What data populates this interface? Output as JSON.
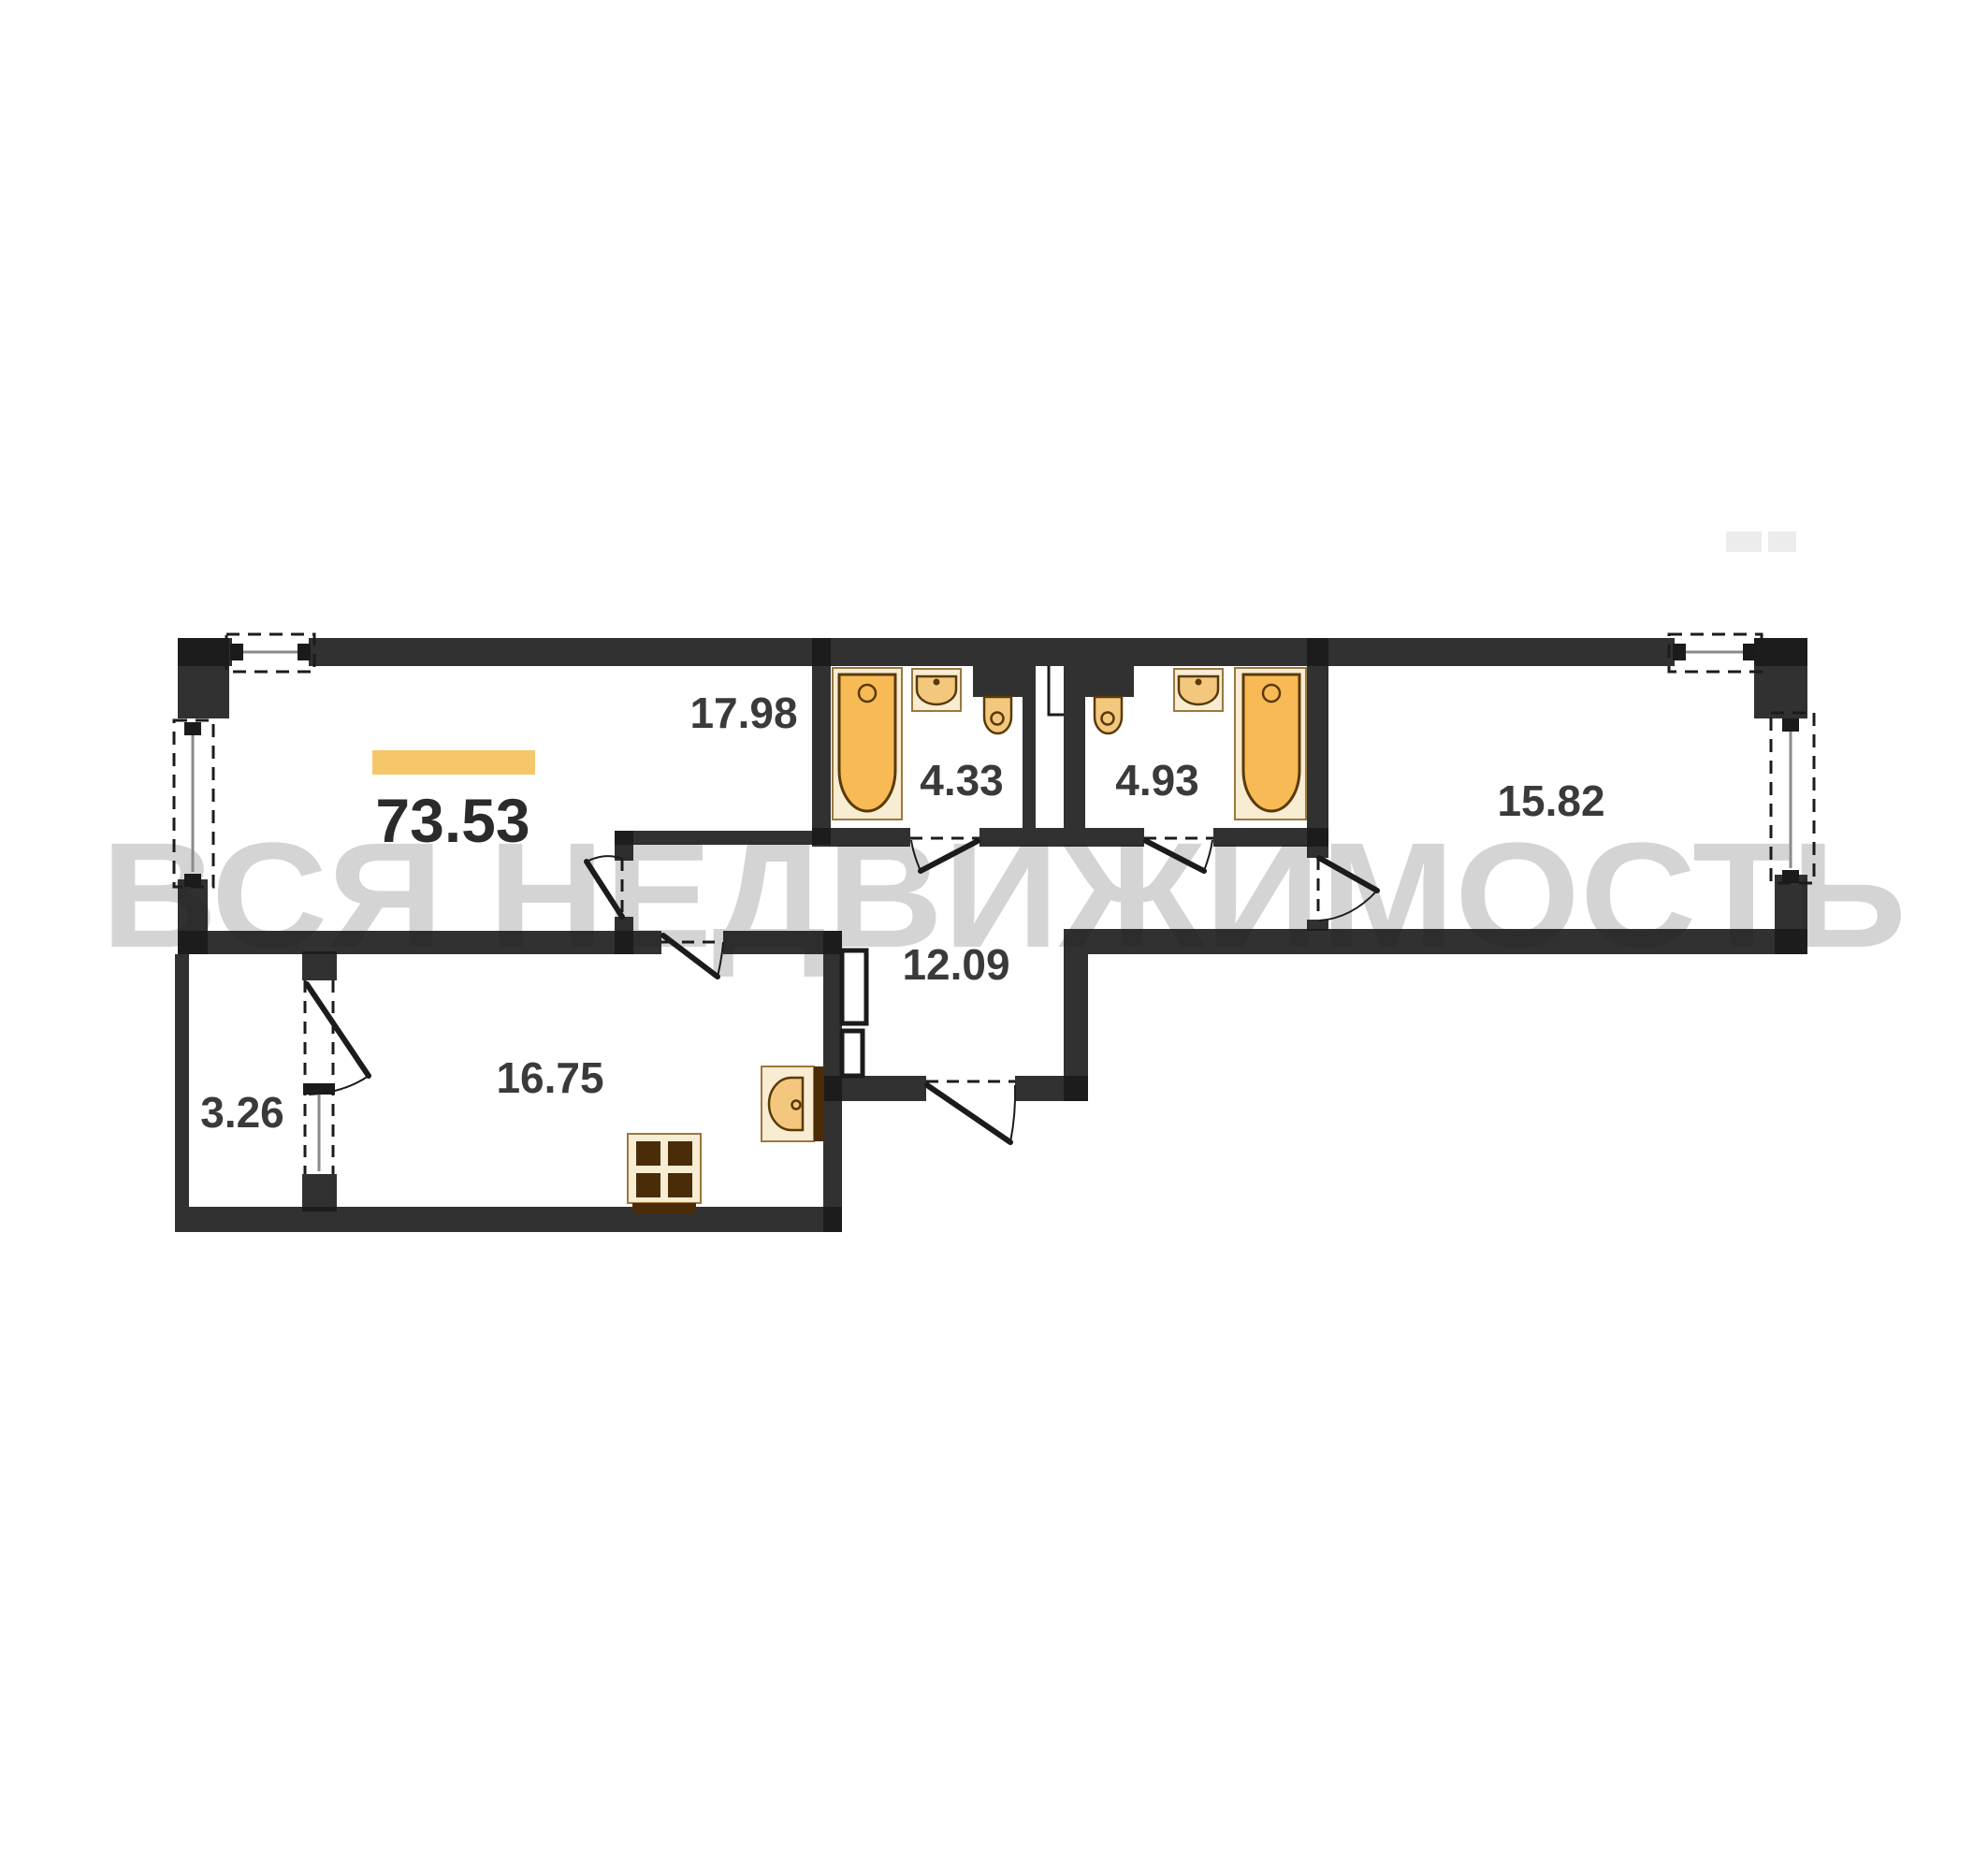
{
  "watermark": {
    "text": "ВСЯ НЕДВИЖИМОСТЬ",
    "color": "#d4d4d4"
  },
  "total": {
    "area": "73.53",
    "bar_color": "#F6C66B"
  },
  "rooms": [
    {
      "name": "living-room",
      "area": "17.98"
    },
    {
      "name": "bathroom-1",
      "area": "4.33"
    },
    {
      "name": "bathroom-2",
      "area": "4.93"
    },
    {
      "name": "bedroom",
      "area": "15.82"
    },
    {
      "name": "hallway",
      "area": "12.09"
    },
    {
      "name": "kitchen-living",
      "area": "16.75"
    },
    {
      "name": "balcony",
      "area": "3.26"
    }
  ],
  "fixtures": [
    {
      "type": "bathtub",
      "room": "4.33"
    },
    {
      "type": "sink",
      "room": "4.33"
    },
    {
      "type": "toilet",
      "room": "4.33"
    },
    {
      "type": "toilet",
      "room": "4.93"
    },
    {
      "type": "sink",
      "room": "4.93"
    },
    {
      "type": "bathtub",
      "room": "4.93"
    },
    {
      "type": "kitchen-sink",
      "room": "16.75"
    },
    {
      "type": "stove",
      "room": "16.75"
    }
  ],
  "colors": {
    "wall": "#1b1b1b",
    "fixture_orange": "#F7BA55",
    "fixture_bowl": "#F3C87E",
    "fixture_pale": "#F8ECD2",
    "fixture_dark_brown": "#4a2c08",
    "label": "#3a3a3a",
    "accent_bar": "#F6C66B",
    "watermark": "#d4d4d4"
  }
}
